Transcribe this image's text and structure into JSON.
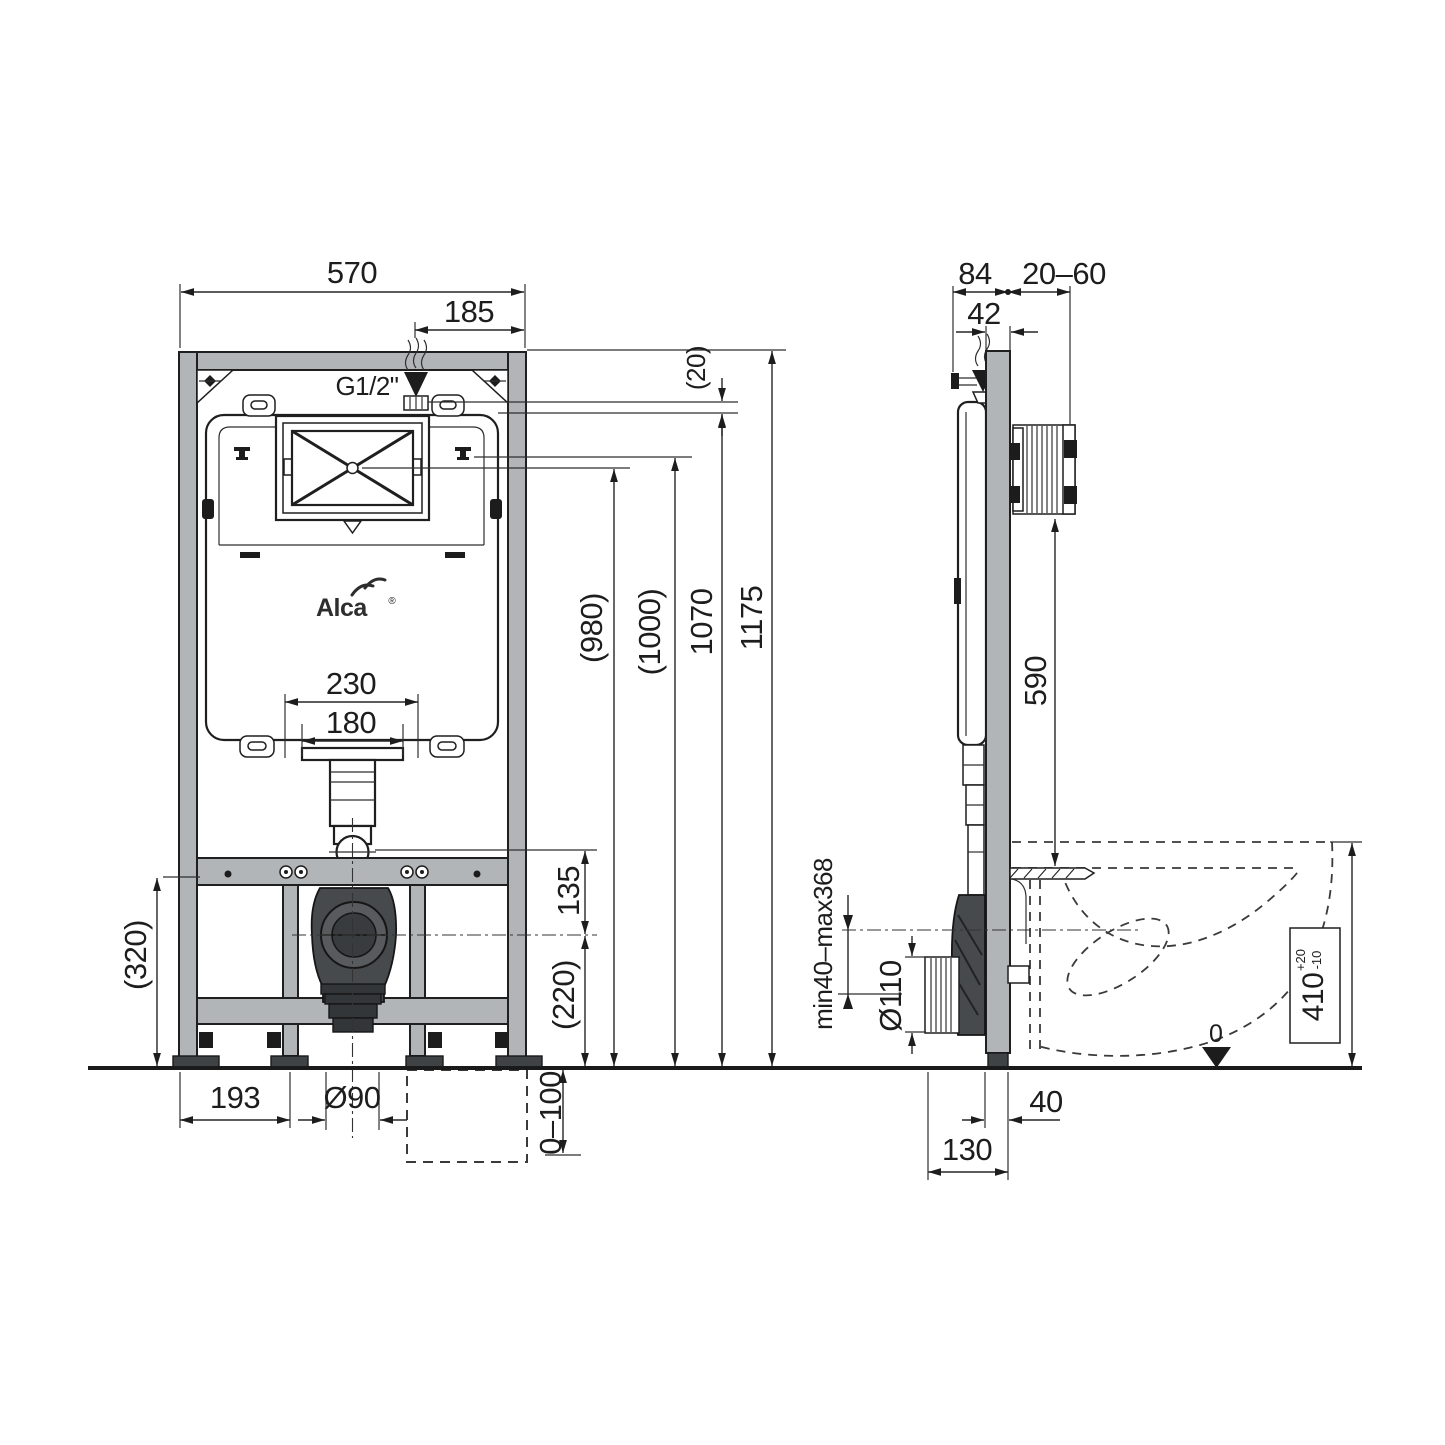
{
  "drawing": {
    "brand": {
      "logo_text": "Alca",
      "registered": "®"
    },
    "front": {
      "width": "570",
      "inlet_offset": "185",
      "inlet_thread": "G1/2\"",
      "flush_mount_outer": "230",
      "flush_mount_inner": "180",
      "lower_section": "(320)",
      "foot_span": "193",
      "drain_dia": "Ø90",
      "pipe_gap": "135",
      "drain_axis_h": "(220)",
      "leg_adjust": "0–100",
      "h_panel_center": "(980)",
      "h_fixing": "(1000)",
      "h_inlet": "1070",
      "h_frame": "1175",
      "top_gap": "(20)"
    },
    "side": {
      "depth": "84",
      "wall_gap": "20–60",
      "profile_depth": "42",
      "flush_drop": "590",
      "drain_axis_range": "min40–max368",
      "drain_dia": "Ø110",
      "foot_depth": "40",
      "base_depth": "130",
      "bowl_height": "410",
      "bowl_tol_up": "+20",
      "bowl_tol_down": "-10",
      "floor_zero": "0"
    }
  }
}
